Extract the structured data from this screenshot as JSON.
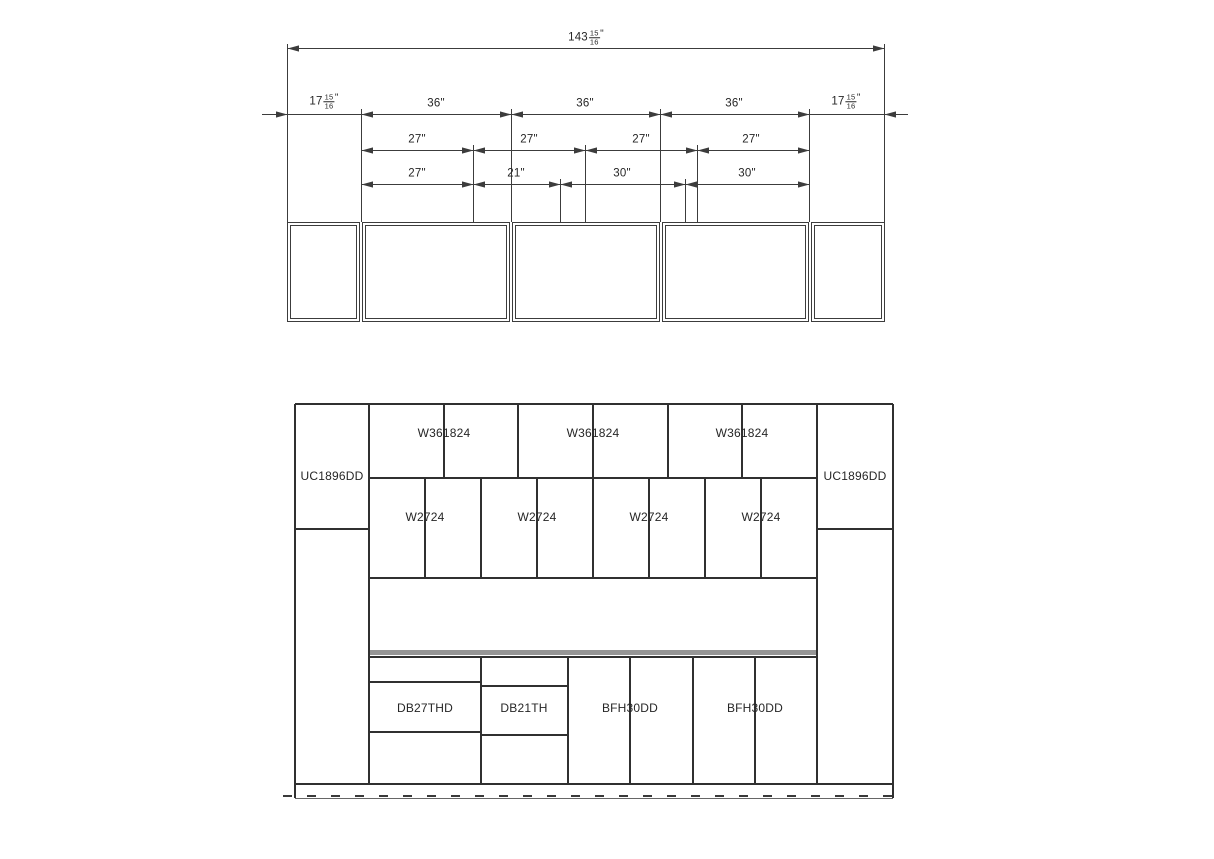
{
  "colors": {
    "background": "#ffffff",
    "plan_line": "#3c3c3c",
    "elevation_line": "#303030",
    "counter_fill": "#969696",
    "text": "#262626"
  },
  "plan_view": {
    "total_dim": {
      "whole": "143",
      "num": "15",
      "den": "16",
      "suffix": "\""
    },
    "row2_dims": [
      {
        "whole": "17",
        "num": "15",
        "den": "16",
        "suffix": "\""
      },
      {
        "label": "36\""
      },
      {
        "label": "36\""
      },
      {
        "label": "36\""
      },
      {
        "whole": "17",
        "num": "15",
        "den": "16",
        "suffix": "\""
      }
    ],
    "row3_dims": [
      {
        "label": "27\""
      },
      {
        "label": "27\""
      },
      {
        "label": "27\""
      },
      {
        "label": "27\""
      }
    ],
    "row4_dims": [
      {
        "label": "27\""
      },
      {
        "label": "21\""
      },
      {
        "label": "30\""
      },
      {
        "label": "30\""
      }
    ]
  },
  "elevation_view": {
    "tall_cabinets": [
      {
        "label": "UC1896DD"
      },
      {
        "label": "UC1896DD"
      }
    ],
    "upper_wall_cabinets": [
      {
        "label": "W361824"
      },
      {
        "label": "W361824"
      },
      {
        "label": "W361824"
      }
    ],
    "lower_wall_cabinets": [
      {
        "label": "W2724"
      },
      {
        "label": "W2724"
      },
      {
        "label": "W2724"
      },
      {
        "label": "W2724"
      }
    ],
    "base_cabinets": [
      {
        "label": "DB27THD"
      },
      {
        "label": "DB21TH"
      },
      {
        "label": "BFH30DD"
      },
      {
        "label": "BFH30DD"
      }
    ]
  }
}
